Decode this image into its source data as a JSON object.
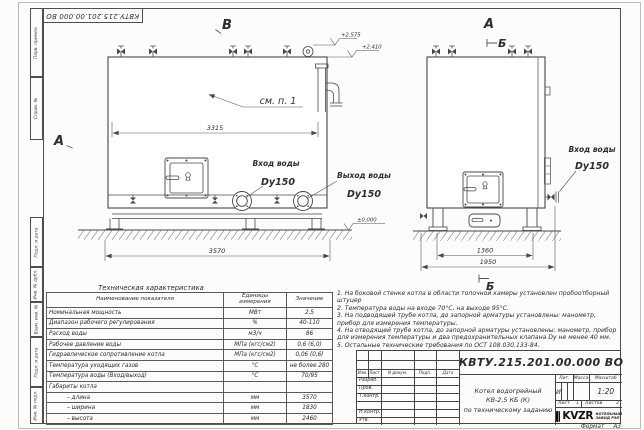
{
  "sheet": {
    "stamp_designation": "КВТУ.215.201.00.000 ВО",
    "format_label": "Формат",
    "format_value": "А3",
    "frame_labels": [
      "Перв. примен.",
      "Справ. №",
      "Подп. и дата",
      "Инв. № дубл.",
      "Взам. инв. №",
      "Подп. и дата",
      "Инв. № подл."
    ]
  },
  "drawing": {
    "view_b": "В",
    "view_a_side": "А",
    "view_a_front": "А",
    "section_b_top": "Б",
    "section_b_bottom": "Б",
    "see_item": "см. п. 1",
    "elev_top": "+2.575",
    "elev_mid": "+2.410",
    "elev_zero": "±0.000",
    "dim_length_inner": "3315",
    "dim_length_total": "3570",
    "dim_width_inner": "1360",
    "dim_width_total": "1950",
    "inlet_label": "Вход воды",
    "inlet_dn": "Dy150",
    "outlet_label": "Выход воды",
    "outlet_dn": "Dy150",
    "inlet2_label": "Вход воды",
    "inlet2_dn": "Dy150"
  },
  "table": {
    "title": "Техническая характеристика",
    "headers": [
      "Наименование показателя",
      "Единицы измерения",
      "Значение"
    ],
    "rows": [
      [
        "Номинальная мощность",
        "МВт",
        "2,5"
      ],
      [
        "Диапазон рабочего регулирования",
        "%",
        "40-110"
      ],
      [
        "Расход воды",
        "м3/ч",
        "86"
      ],
      [
        "Рабочее давление воды",
        "МПа (кгс/см2)",
        "0,6 (6,0)"
      ],
      [
        "Гидравлическое сопротивление котла",
        "МПа (кгс/см2)",
        "0,06 (0,6)"
      ],
      [
        "Температура уходящих газов",
        "°С",
        "не более 280"
      ],
      [
        "Температура воды (Вход/выход)",
        "°С",
        "70/95"
      ],
      [
        "Габариты котла",
        "",
        ""
      ],
      [
        "– длина",
        "мм",
        "3570"
      ],
      [
        "– ширина",
        "мм",
        "1830"
      ],
      [
        "– высота",
        "мм",
        "2460"
      ]
    ]
  },
  "notes": [
    "1.  На боковой стенке котла в области топочной камеры установлен пробоотборный штуцер",
    "2.  Температура воды на входе 70°С, на выходе 95°С.",
    "3.  На подводящей трубе котла, до запорной арматуры установлены: манометр, прибор для измерения температуры.",
    "4.  На отводящей трубе котла, до запорной арматуры установлены: манометр, прибор для измерения температуры и два предохранительных клапана Dу не менее 40 мм.",
    "5.  Остальные технические требования по ОСТ 108.030.133-84."
  ],
  "title_block": {
    "designation": "КВТУ.215.201.00.000 ВО",
    "doc_name": [
      "Котел водогрейный",
      "КВ-2,5 КБ (К)",
      "по техническому заданию"
    ],
    "columns": [
      "Изм.",
      "Лист",
      "N докум.",
      "Подп.",
      "Дата"
    ],
    "roles": [
      "Разраб.",
      "Пров.",
      "Т.контр.",
      "",
      "Н.контр.",
      "Утв."
    ],
    "lit_label": "Лит.",
    "mass_label": "Масса",
    "scale_label": "Масштаб",
    "lit_value": "И",
    "scale_value": "1:20",
    "sheet_label": "Лист",
    "sheet_value": "1",
    "sheets_label": "Листов",
    "sheets_value": "2",
    "logo_text": "KVZR",
    "logo_sub1": "КОТЕЛЬНЫЙ",
    "logo_sub2": "ЗАВОД РЭП"
  }
}
